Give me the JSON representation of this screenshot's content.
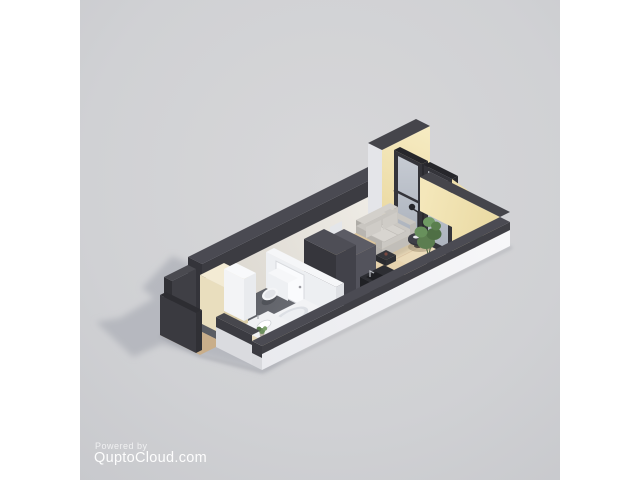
{
  "watermark": {
    "prefix": "Powered by",
    "brand": "QuptoCloud.com"
  },
  "scene": {
    "description": "Isometric 3D render of a studio apartment floor plan casting a soft shadow on a gray backdrop",
    "rooms": [
      "living-dining-area",
      "bathroom",
      "entry",
      "balcony-window-bay"
    ],
    "furniture": [
      "sofa",
      "floor-lamp",
      "coffee-table",
      "potted-plant",
      "dining-table",
      "dining-chairs",
      "side-stool",
      "wardrobe",
      "kitchenette-counter",
      "toilet",
      "bathtub",
      "vanity-sink",
      "storage-cabinet",
      "mirror-panel",
      "entry-door",
      "glass-door-windows",
      "balcony-plant"
    ]
  },
  "colors": {
    "side_bands": "#ffffff",
    "backdrop": "#cfd0d4",
    "shadow": "#b3b5bc",
    "wall_top_dark": "#46464c",
    "wall_white": "#f2f2f4",
    "floor_wood": "#e2cda6",
    "bathroom_floor": "#5d5f66",
    "accent_cream": "#f0e2b0",
    "furniture_dark": "#3a3a40",
    "sofa_gray": "#cbc8c3",
    "plant_green": "#5c7d50",
    "watermark_text": "#ffffff"
  }
}
